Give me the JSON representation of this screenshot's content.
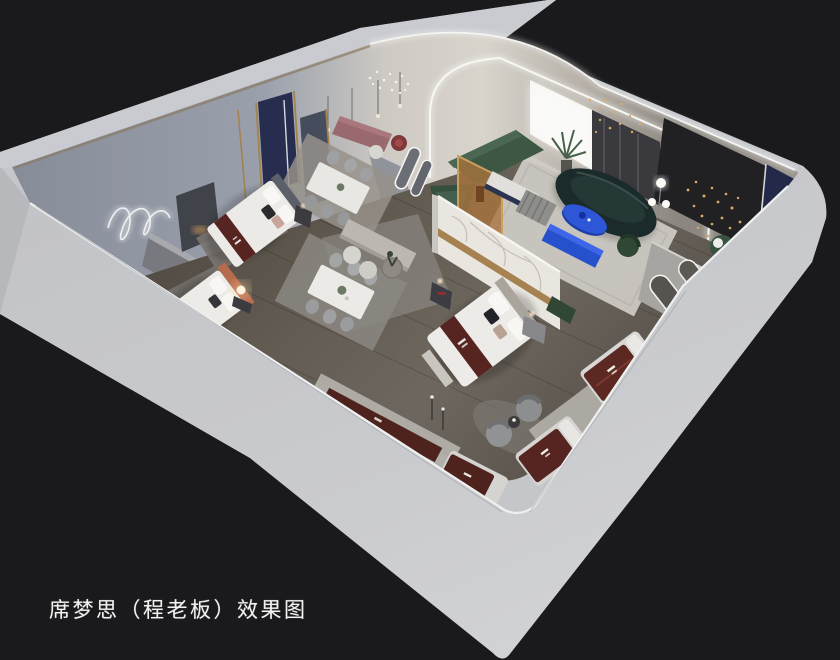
{
  "scene": {
    "kind": "isometric cutaway interior rendering",
    "subject": "mattress showroom floor plan perspective view"
  },
  "caption": {
    "text": "席梦思（程老板）效果图"
  },
  "palette": {
    "background": "#1a1a1c",
    "outer_wall": "#c4c6ca",
    "outer_wall_bright": "#d3d4d6",
    "inner_wall_cool": "#949aa6",
    "inner_wall_warm": "#d7d3cb",
    "ceiling_trim": "#8a7a62",
    "floor_wood": "#675f56",
    "floor_shadow": "#49433d",
    "rug_light": "#adaaa5",
    "platform_stone": "#b2afa9",
    "marble_panel": "#e9e6e0",
    "gold_trim": "#a5824f",
    "bedding_white": "#eceae6",
    "headboard_gray": "#5a5f68",
    "headboard_orange": "#b66a4e",
    "mattress_runner_maroon": "#572521",
    "sofa_green": "#3e5743",
    "sofa_teal_dark": "#1b2a2a",
    "accent_cobalt": "#2e57d8",
    "navy_panel": "#232948",
    "glass_amber": "#a8743f",
    "mauve_bench": "#9a696d",
    "led_white": "#f5f6f2",
    "string_light_gold": "#d8ab66",
    "lamp_warm": "#ffb45e",
    "caption_text": "#f2f2f2"
  }
}
